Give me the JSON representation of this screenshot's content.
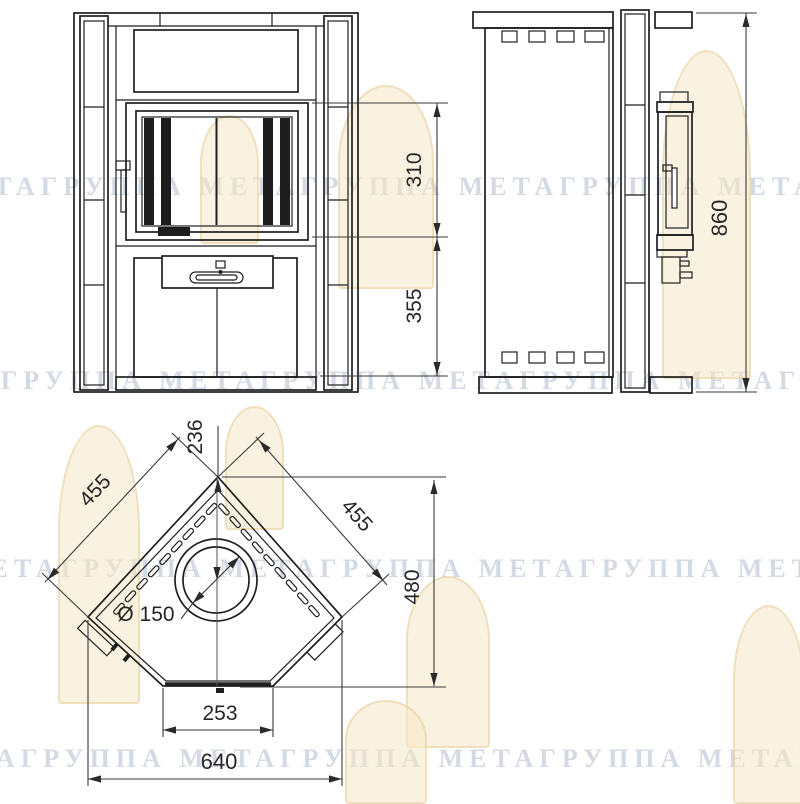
{
  "page": {
    "background": "#ffffff",
    "line_color": "#1f1f1f",
    "dim_text_color": "#262626",
    "watermark_color": "#94a2bc",
    "logo_color": "#f5e7c7"
  },
  "watermark": {
    "row_text": "МЕТАГРУППА МЕТАГРУППА МЕТАГРУППА МЕТАГРУППА МЕТАГРУППА"
  },
  "views": {
    "front": {
      "name": "front view of corner stove"
    },
    "side": {
      "name": "side view of corner stove"
    },
    "plan": {
      "name": "top plan view of corner stove"
    }
  },
  "dimensions": {
    "firebox_opening_height": "310",
    "base_section_height": "355",
    "overall_height": "860",
    "corner_to_flue_center": "236",
    "left_side_panel": "455",
    "right_side_panel": "455",
    "overall_depth": "480",
    "flue_diameter": "Ø 150",
    "front_panel_width": "253",
    "overall_width": "640"
  }
}
